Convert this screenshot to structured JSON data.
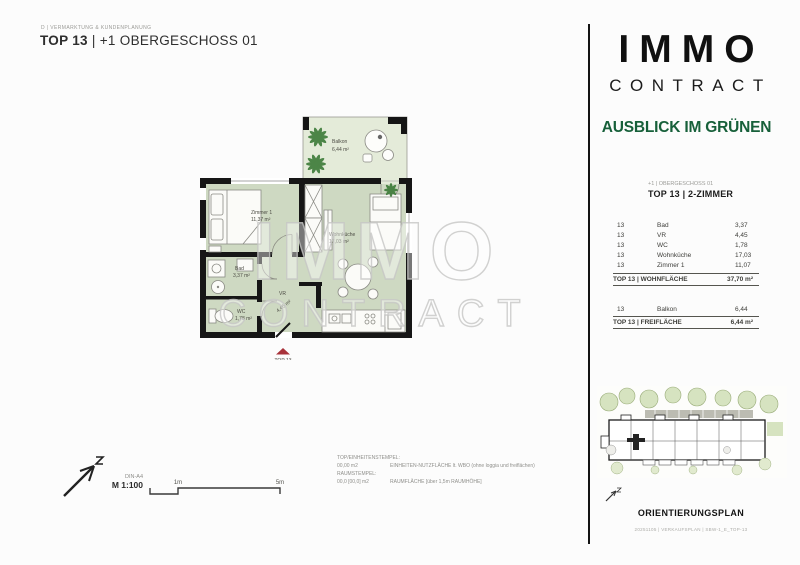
{
  "header": {
    "department": "D | VERMARKTUNG & KUNDENPLANUNG",
    "title_bold": "TOP 13",
    "title_rest": " | +1 OBERGESCHOSS 01"
  },
  "brand": {
    "logo_line1": "IMMO",
    "logo_line2": "CONTRACT",
    "tagline": "AUSBLICK IM GRÜNEN",
    "tagline_color": "#17603a"
  },
  "unit": {
    "floor_label": "+1 | OBERGESCHOSS 01",
    "unit_label": "TOP 13 | 2-ZIMMER"
  },
  "area_table": {
    "rows": [
      {
        "top": "13",
        "room": "Bad",
        "area": "3,37"
      },
      {
        "top": "13",
        "room": "VR",
        "area": "4,45"
      },
      {
        "top": "13",
        "room": "WC",
        "area": "1,78"
      },
      {
        "top": "13",
        "room": "Wohnküche",
        "area": "17,03"
      },
      {
        "top": "13",
        "room": "Zimmer 1",
        "area": "11,07"
      }
    ],
    "total_label": "TOP 13 | WOHNFLÄCHE",
    "total_value": "37,70 m²"
  },
  "outdoor_table": {
    "rows": [
      {
        "top": "13",
        "room": "Balkon",
        "area": "6,44"
      }
    ],
    "total_label": "TOP 13 | FREIFLÄCHE",
    "total_value": "6,44 m²"
  },
  "floorplan": {
    "rooms": [
      {
        "name": "Balkon",
        "area": "6,44 m²"
      },
      {
        "name": "Zimmer 1",
        "area": "11,37 m²"
      },
      {
        "name": "Wohnküche",
        "area": "17,03 m²"
      },
      {
        "name": "Bad",
        "area": "3,37 m²"
      },
      {
        "name": "WC",
        "area": "1,78 m²"
      },
      {
        "name": "VR",
        "area": "4,45 m²"
      }
    ],
    "marker": "TOP 13",
    "marker_color": "#a8323a",
    "watermark_line1": "IMMO",
    "watermark_line2": "CONTRACT",
    "room_fill": "#ced9c2",
    "balcony_fill": "#e4ebd9"
  },
  "scale": {
    "paper": "DIN-A4",
    "scale_label": "M 1:100",
    "tick1": "1m",
    "tick2": "5m"
  },
  "stamp": {
    "line1": "TOP/EINHEITENSTEMPEL:",
    "line2_value": "00,00 m2",
    "line2_desc": "EINHEITEN-NUTZFLÄCHE lt. WBO (ohne loggia und freiflächen)",
    "line3": "RAUMSTEMPEL:",
    "line4_value": "00,0 [00,0] m2",
    "line4_desc": "RAUMFLÄCHE [über 1,5m RAUMHÖHE]"
  },
  "orientation": {
    "title": "ORIENTIERUNGSPLAN",
    "footer": "20251105 | VERKAUFSPLAN | SBW-1_E_TOP-13"
  }
}
